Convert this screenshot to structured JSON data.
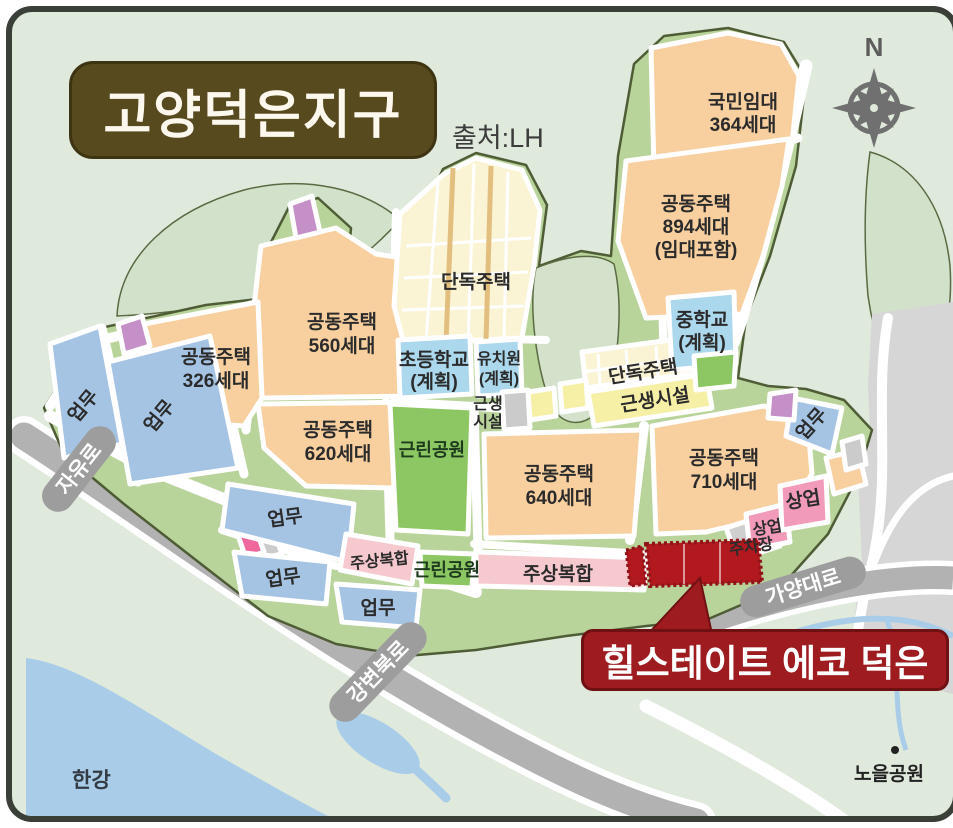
{
  "title": "고양덕은지구",
  "source": "출처:LH",
  "compass": {
    "north": "N"
  },
  "callout": {
    "label": "힐스테이트 에코 덕은"
  },
  "zones": {
    "national_rental": {
      "l1": "국민임대",
      "l2": "364세대"
    },
    "apt894": {
      "l1": "공동주택",
      "l2": "894세대",
      "l3": "(임대포함)"
    },
    "apt560": {
      "l1": "공동주택",
      "l2": "560세대"
    },
    "apt326": {
      "l1": "공동주택",
      "l2": "326세대"
    },
    "apt620": {
      "l1": "공동주택",
      "l2": "620세대"
    },
    "apt640": {
      "l1": "공동주택",
      "l2": "640세대"
    },
    "apt710": {
      "l1": "공동주택",
      "l2": "710세대"
    },
    "detached1": {
      "label": "단독주택"
    },
    "detached2": {
      "label": "단독주택"
    },
    "elementary": {
      "l1": "초등학교",
      "l2": "(계획)"
    },
    "kindergarten": {
      "l1": "유치원",
      "l2": "(계획)"
    },
    "middle_school": {
      "l1": "중학교",
      "l2": "(계획)"
    },
    "neighborhood1": {
      "l1": "근생",
      "l2": "시설"
    },
    "neighborhood2": {
      "label": "근생시설"
    },
    "park": {
      "label": "근린공원"
    },
    "business": {
      "label": "업무"
    },
    "commercial": {
      "label": "상업"
    },
    "mixed_use": {
      "label": "주상복합"
    },
    "parking": {
      "label": "주차장"
    }
  },
  "roads": {
    "jayuro": "자유로",
    "gangbyeon": "강변북로",
    "gayang": "가양대로"
  },
  "places": {
    "han_river": "한강",
    "noeul_park": "노을공원"
  },
  "colors": {
    "background": "#dfe9dc",
    "district_green": "#b9d49b",
    "hill_green": "#d4e2cc",
    "apartment_orange": "#f8d0a0",
    "detached_cream": "#faf3d4",
    "school_blue": "#abd8ec",
    "business_blue": "#a5c4e4",
    "commercial_pink": "#f29ab9",
    "mixed_use_pink": "#f6c9cf",
    "park_green": "#8cc763",
    "facility_yellow": "#f6efa6",
    "facility_gray": "#cbcbcb",
    "purple_parcel": "#c58fc7",
    "site_red": "#b2191e",
    "callout_red": "#9e1b20",
    "title_olive": "#574a1e",
    "road_gray": "#b2b2b2",
    "water_blue": "#a9cde9"
  }
}
